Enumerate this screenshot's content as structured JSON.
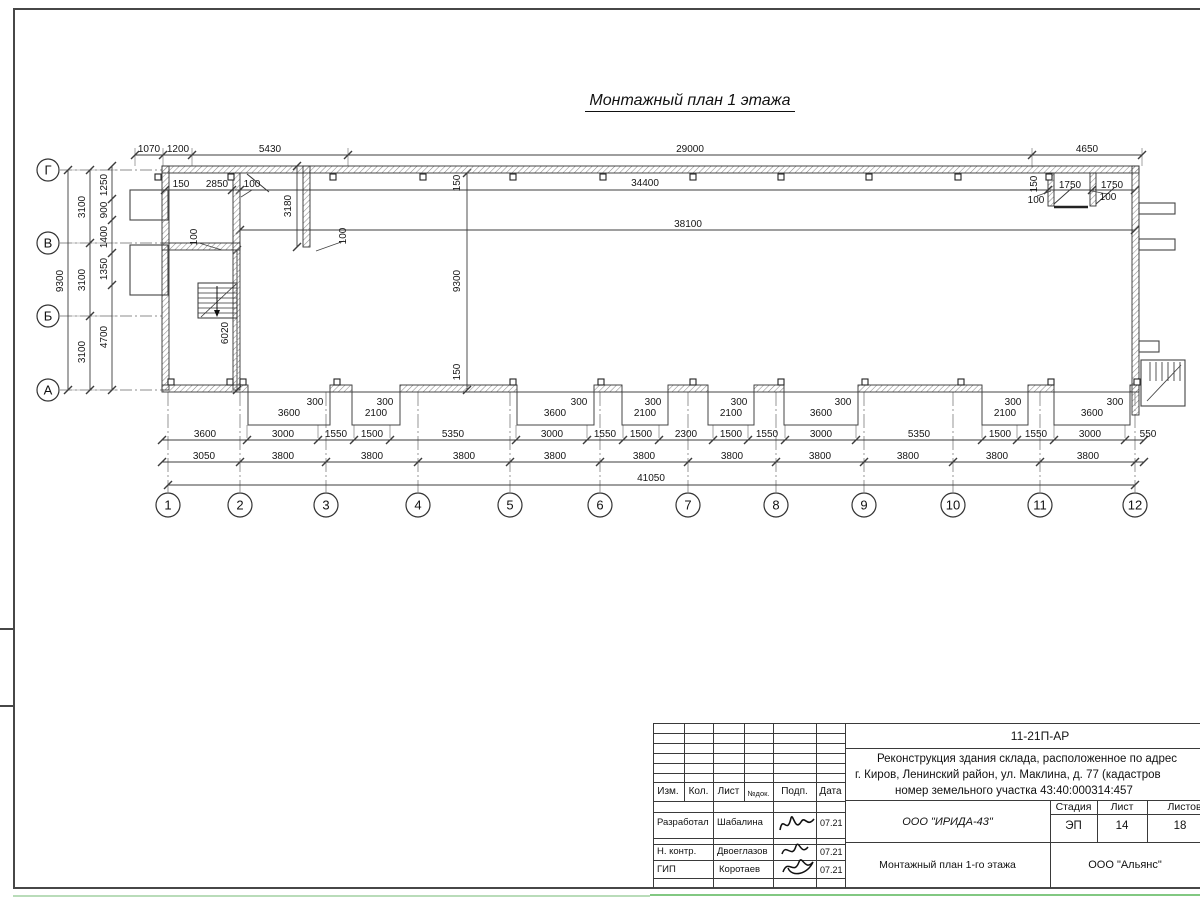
{
  "page_title": "Монтажный план 1 этажа",
  "plan": {
    "axis_letters": [
      "Г",
      "В",
      "Б",
      "А"
    ],
    "axis_numbers": [
      "1",
      "2",
      "3",
      "4",
      "5",
      "6",
      "7",
      "8",
      "9",
      "10",
      "11",
      "12"
    ],
    "dim_labels": [
      {
        "t": "1070",
        "x": 149,
        "y": 152
      },
      {
        "t": "1200",
        "x": 178,
        "y": 152
      },
      {
        "t": "5430",
        "x": 270,
        "y": 152
      },
      {
        "t": "29000",
        "x": 690,
        "y": 152
      },
      {
        "t": "4650",
        "x": 1087,
        "y": 152
      },
      {
        "t": "150",
        "x": 181,
        "y": 187
      },
      {
        "t": "2850",
        "x": 217,
        "y": 187
      },
      {
        "t": "100",
        "x": 252,
        "y": 187
      },
      {
        "t": "34400",
        "x": 645,
        "y": 186
      },
      {
        "t": "38100",
        "x": 688,
        "y": 227
      },
      {
        "t": "1750",
        "x": 1070,
        "y": 188
      },
      {
        "t": "1750",
        "x": 1112,
        "y": 188
      },
      {
        "t": "100",
        "x": 1036,
        "y": 203
      },
      {
        "t": "100",
        "x": 1108,
        "y": 200
      },
      {
        "t": "300",
        "x": 315,
        "y": 405
      },
      {
        "t": "300",
        "x": 385,
        "y": 405
      },
      {
        "t": "300",
        "x": 579,
        "y": 405
      },
      {
        "t": "300",
        "x": 653,
        "y": 405
      },
      {
        "t": "300",
        "x": 739,
        "y": 405
      },
      {
        "t": "300",
        "x": 843,
        "y": 405
      },
      {
        "t": "300",
        "x": 1013,
        "y": 405
      },
      {
        "t": "300",
        "x": 1115,
        "y": 405
      },
      {
        "t": "3600",
        "x": 289,
        "y": 416
      },
      {
        "t": "2100",
        "x": 376,
        "y": 416
      },
      {
        "t": "3600",
        "x": 555,
        "y": 416
      },
      {
        "t": "2100",
        "x": 645,
        "y": 416
      },
      {
        "t": "2100",
        "x": 731,
        "y": 416
      },
      {
        "t": "3600",
        "x": 821,
        "y": 416
      },
      {
        "t": "2100",
        "x": 1005,
        "y": 416
      },
      {
        "t": "3600",
        "x": 1092,
        "y": 416
      },
      {
        "t": "3600",
        "x": 205,
        "y": 437
      },
      {
        "t": "3000",
        "x": 283,
        "y": 437
      },
      {
        "t": "1550",
        "x": 336,
        "y": 437
      },
      {
        "t": "1500",
        "x": 372,
        "y": 437
      },
      {
        "t": "5350",
        "x": 453,
        "y": 437
      },
      {
        "t": "3000",
        "x": 552,
        "y": 437
      },
      {
        "t": "1550",
        "x": 605,
        "y": 437
      },
      {
        "t": "1500",
        "x": 641,
        "y": 437
      },
      {
        "t": "2300",
        "x": 686,
        "y": 437
      },
      {
        "t": "1500",
        "x": 731,
        "y": 437
      },
      {
        "t": "1550",
        "x": 767,
        "y": 437
      },
      {
        "t": "3000",
        "x": 821,
        "y": 437
      },
      {
        "t": "5350",
        "x": 919,
        "y": 437
      },
      {
        "t": "1500",
        "x": 1000,
        "y": 437
      },
      {
        "t": "1550",
        "x": 1036,
        "y": 437
      },
      {
        "t": "3000",
        "x": 1090,
        "y": 437
      },
      {
        "t": "550",
        "x": 1148,
        "y": 437
      },
      {
        "t": "3050",
        "x": 204,
        "y": 459
      },
      {
        "t": "3800",
        "x": 283,
        "y": 459
      },
      {
        "t": "3800",
        "x": 372,
        "y": 459
      },
      {
        "t": "3800",
        "x": 464,
        "y": 459
      },
      {
        "t": "3800",
        "x": 555,
        "y": 459
      },
      {
        "t": "3800",
        "x": 644,
        "y": 459
      },
      {
        "t": "3800",
        "x": 732,
        "y": 459
      },
      {
        "t": "3800",
        "x": 820,
        "y": 459
      },
      {
        "t": "3800",
        "x": 908,
        "y": 459
      },
      {
        "t": "3800",
        "x": 997,
        "y": 459
      },
      {
        "t": "3800",
        "x": 1088,
        "y": 459
      },
      {
        "t": "41050",
        "x": 651,
        "y": 481
      },
      {
        "t": "150",
        "x": 460,
        "y": 183,
        "r": 1
      },
      {
        "t": "9300",
        "x": 460,
        "y": 281,
        "r": 1
      },
      {
        "t": "150",
        "x": 460,
        "y": 372,
        "r": 1
      },
      {
        "t": "150",
        "x": 1037,
        "y": 184,
        "r": 1
      },
      {
        "t": "3180",
        "x": 291,
        "y": 206,
        "r": 1
      },
      {
        "t": "100",
        "x": 197,
        "y": 237,
        "r": 1
      },
      {
        "t": "100",
        "x": 346,
        "y": 236,
        "r": 1
      },
      {
        "t": "6020",
        "x": 228,
        "y": 333,
        "r": 1
      },
      {
        "t": "1250",
        "x": 107,
        "y": 185,
        "r": 1
      },
      {
        "t": "900",
        "x": 107,
        "y": 210,
        "r": 1
      },
      {
        "t": "1400",
        "x": 107,
        "y": 237,
        "r": 1
      },
      {
        "t": "1350",
        "x": 107,
        "y": 269,
        "r": 1
      },
      {
        "t": "4700",
        "x": 107,
        "y": 337,
        "r": 1
      },
      {
        "t": "3100",
        "x": 85,
        "y": 207,
        "r": 1
      },
      {
        "t": "3100",
        "x": 85,
        "y": 280,
        "r": 1
      },
      {
        "t": "3100",
        "x": 85,
        "y": 352,
        "r": 1
      },
      {
        "t": "9300",
        "x": 63,
        "y": 281,
        "r": 1
      }
    ]
  },
  "title_block": {
    "doc_code": "11-21П-АР",
    "project_lines": [
      "Реконструкция здания склада, расположенное по адрес",
      "г. Киров, Ленинский район, ул. Маклина, д. 77 (кадастров",
      "номер земельного участка 43:40:000314:457"
    ],
    "header_cols": {
      "izm": "Изм.",
      "kol": "Кол.",
      "list": "Лист",
      "ndok": "№док.",
      "podp": "Подп.",
      "data": "Дата"
    },
    "rows": [
      {
        "role": "Разработал",
        "name": "Шабалина",
        "date": "07.21"
      },
      {
        "role": "Н. контр.",
        "name": "Двоеглазов",
        "date": "07.21"
      },
      {
        "role": "ГИП",
        "name": "Коротаев",
        "date": "07.21"
      }
    ],
    "org_center": "ООО \"ИРИДА-43\"",
    "sheet_title": "Монтажный план 1-го этажа",
    "org_right": "ООО \"Альянс\"",
    "stage_label": "Стадия",
    "sheet_label": "Лист",
    "sheets_label": "Листов",
    "stage": "ЭП",
    "sheet": "14",
    "sheets": "18"
  }
}
